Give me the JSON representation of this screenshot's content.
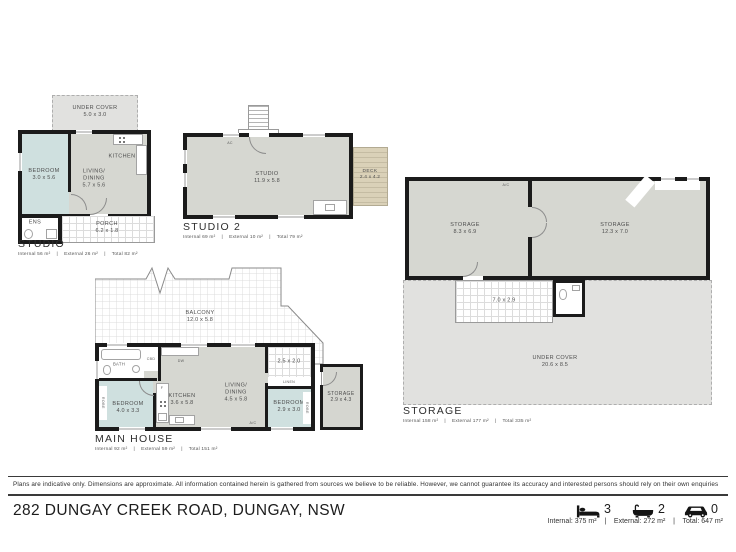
{
  "studio": {
    "title": "STUDIO",
    "stats": "Internal 56 m²    |    External 26 m²    |    Total 82 m²",
    "under_cover": {
      "label": "UNDER COVER",
      "dims": "5.0 x 3.0"
    },
    "bedroom": {
      "label": "BEDROOM",
      "dims": "3.0 x 5.6"
    },
    "living": {
      "label": "LIVING/\nDINING",
      "dims": "5.7 x 5.6"
    },
    "kitchen": {
      "label": "KITCHEN"
    },
    "ens": {
      "label": "ENS"
    },
    "porch": {
      "label": "PORCH",
      "dims": "6.2 x 1.8"
    }
  },
  "studio2": {
    "title": "STUDIO 2",
    "stats": "Internal 69 m²    |    External 10 m²    |    Total 79 m²",
    "studio": {
      "label": "STUDIO",
      "dims": "11.9 x 5.8"
    },
    "deck": {
      "label": "DECK",
      "dims": "2.4 x 4.2"
    },
    "ac": "AC"
  },
  "storage": {
    "title": "STORAGE",
    "stats": "Internal 158 m²    |    External 177 m²    |    Total 335 m²",
    "room1": {
      "label": "STORAGE",
      "dims": "8.3 x 6.9"
    },
    "room2": {
      "label": "STORAGE",
      "dims": "12.3 x 7.0"
    },
    "porch": {
      "dims": "7.0 x 2.9"
    },
    "under_cover": {
      "label": "UNDER COVER",
      "dims": "20.6 x 8.5"
    },
    "ac": "A/C"
  },
  "main_house": {
    "title": "MAIN HOUSE",
    "stats": "Internal 92 m²    |    External 59 m²    |    Total 151 m²",
    "balcony": {
      "label": "BALCONY",
      "dims": "12.0 x 5.8"
    },
    "bath": {
      "label": "BATH"
    },
    "bedroom1": {
      "label": "BEDROOM",
      "dims": "4.0 x 3.3"
    },
    "kitchen": {
      "label": "KITCHEN",
      "dims": "3.6 x 5.8"
    },
    "living": {
      "label": "LIVING/\nDINING",
      "dims": "4.5 x 5.8"
    },
    "laundry": {
      "dims": "2.5 x 2.0"
    },
    "linen": "LINEN",
    "bedroom2": {
      "label": "BEDROOM",
      "dims": "2.9 x 3.0"
    },
    "storage": {
      "label": "STORAGE",
      "dims": "2.9 x 4.3"
    },
    "ac": "A/C",
    "robe": "ROBE",
    "dw": "DW",
    "cbd": "CBD",
    "fridge": "F"
  },
  "footer": {
    "disclaimer": "Plans are indicative only. Dimensions are approximate. All information contained herein is gathered from sources we believe to be reliable. However, we cannot guarantee its accuracy and interested persons should rely on their own enquiries",
    "address": "282 DUNGAY CREEK ROAD, DUNGAY, NSW",
    "beds": "3",
    "baths": "2",
    "cars": "0",
    "areas": "Internal: 375 m²    |    External: 272 m²    |    Total: 647 m²"
  },
  "icons": {
    "beds": "bed-icon",
    "baths": "bath-icon",
    "cars": "car-icon"
  },
  "colors": {
    "wall": "#1b1b1b",
    "floor": "#d6d7d1",
    "bedroom": "#cfe0df",
    "deck": "#d8cfb6",
    "under_cover": "#e1e1df"
  }
}
